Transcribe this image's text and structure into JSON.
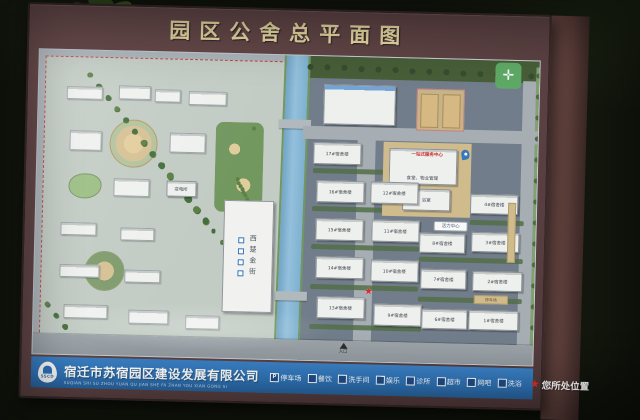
{
  "board": {
    "title": "园区公舍总平面图",
    "footer": {
      "logo_text": "SSCD",
      "company_name": "宿迁市苏宿园区建设发展有限公司",
      "company_pinyin": "SUQIAN SHI SU ZHOU YUAN QU JIAN SHE FA ZHAN YOU XIAN GONG SI",
      "legend": {
        "parking_symbol": "P",
        "location_symbol": "★",
        "items": [
          {
            "label": "停车场"
          },
          {
            "label": "餐饮"
          },
          {
            "label": "洗手间"
          },
          {
            "label": "娱乐"
          },
          {
            "label": "诊所"
          },
          {
            "label": "超市"
          },
          {
            "label": "网吧"
          },
          {
            "label": "洗浴"
          },
          {
            "label": "您所处位置"
          }
        ]
      }
    }
  },
  "map": {
    "dorms": [
      "17#宿舍楼",
      "16#宿舍楼",
      "12#宿舍楼",
      "15#宿舍楼",
      "11#宿舍楼",
      "14#宿舍楼",
      "10#宿舍楼",
      "13#宿舍楼",
      "9#宿舍楼",
      "8#宿舍楼",
      "7#宿舍楼",
      "6#宿舍楼",
      "4#宿舍楼",
      "3#宿舍楼",
      "2#宿舍楼",
      "1#宿舍楼"
    ],
    "facilities": {
      "canteen_property": "食堂、物业管理",
      "bath_house": "浴室",
      "service_center": "一站式服务中心",
      "vitality_center": "活力中心",
      "gold_street": "西楚金街",
      "substation": "变电所",
      "parking_lot": "停车场",
      "entrance": "入口"
    },
    "location_star": "★",
    "colors": {
      "frame_maroon": "#5f4445",
      "title_gold": "#e9dca6",
      "bar_blue": "#2f74b8",
      "water": "#93c1dd",
      "ground_left": "#c4cdc4",
      "ground_right": "#6e7a86",
      "boundary_red": "#c43b2e",
      "location_red": "#d62b20"
    }
  }
}
